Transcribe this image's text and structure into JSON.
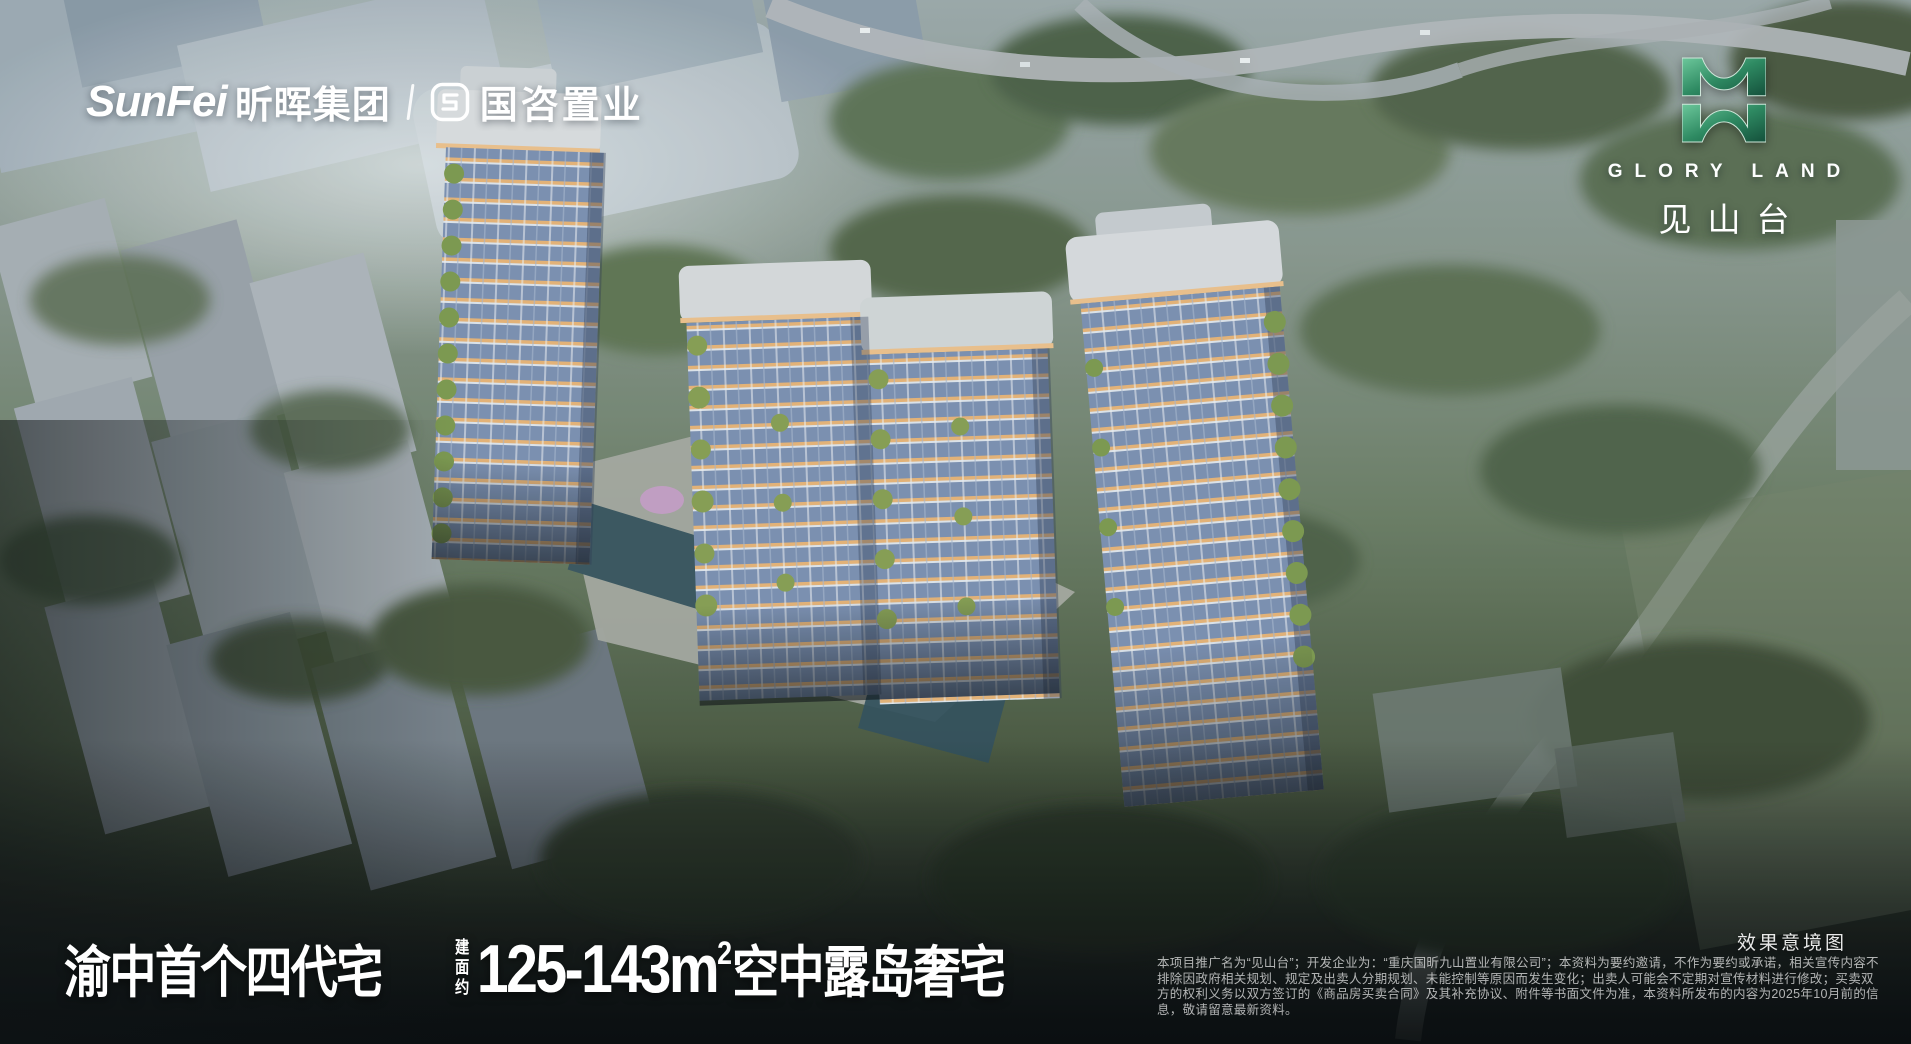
{
  "header": {
    "sunfei_latin": "SunFei",
    "sunfei_cn": "昕晖集团",
    "guozi_cn": "国咨置业"
  },
  "project_logo": {
    "latin": "GLORY LAND",
    "cn": "见山台"
  },
  "headline": {
    "prefix": "渝中首个四代宅",
    "area_label": "建面约",
    "area_value": "125-143m",
    "area_sup": "2",
    "suffix": "空中露岛奢宅"
  },
  "footnote": {
    "caption": "效果意境图",
    "disclaimer": "本项目推广名为“见山台”；开发企业为：“重庆国昕九山置业有限公司”；本资料为要约邀请，不作为要约或承诺，相关宣传内容不排除因政府相关规划、规定及出卖人分期规划、未能控制等原因而发生变化；出卖人可能会不定期对宣传材料进行修改；买卖双方的权利义务以双方签订的《商品房买卖合同》及其补充协议、附件等书面文件为准，本资料所发布的内容为2025年10月前的信息，敬请留意最新资料。"
  },
  "colors": {
    "logo_green_light": "#6cc79b",
    "logo_green": "#2e8a62",
    "logo_green_dark": "#14503b",
    "accent_orange": "#e8b578",
    "glass_blue": "#7c91b3",
    "text_white": "#ffffff"
  }
}
